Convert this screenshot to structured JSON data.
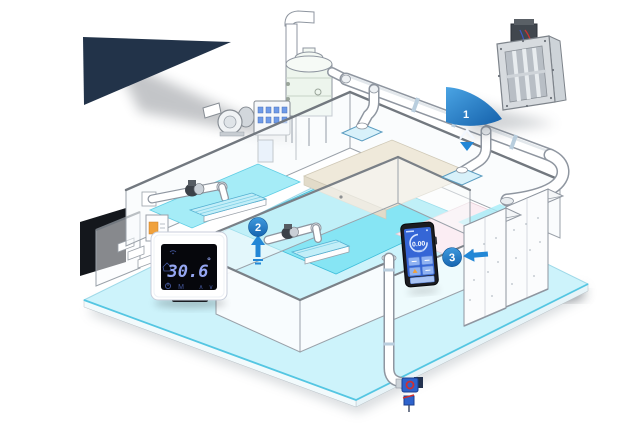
{
  "scene": {
    "background_color": "#ffffff",
    "backdrop_color": "#223349",
    "accent_blue": "#1f7fd0",
    "floor_color": "#cdf3fb",
    "pool_color": "#86e5f4",
    "platform_color": "#efe9da",
    "pink_floor_color": "#fbedf3",
    "controller_screen_color": "#3566d6"
  },
  "markers": [
    {
      "id": 1,
      "label": "1",
      "style": "flag",
      "arrow_icon": "up-arrow-icon"
    },
    {
      "id": 2,
      "label": "2",
      "style": "circle",
      "arrow_icon": "up-arrow-icon"
    },
    {
      "id": 3,
      "label": "3",
      "style": "circle",
      "arrow_icon": "left-arrow-icon"
    }
  ],
  "thermostat": {
    "reading": "30.6",
    "unit": "°",
    "mode_label": "M",
    "up_label": "∧",
    "down_label": "∨",
    "icons": [
      "wifi-icon",
      "home-icon",
      "power-icon"
    ]
  },
  "controller": {
    "reading": "0.00",
    "icons": [
      "gauge-icon",
      "button-grid",
      "warning-icon"
    ]
  }
}
